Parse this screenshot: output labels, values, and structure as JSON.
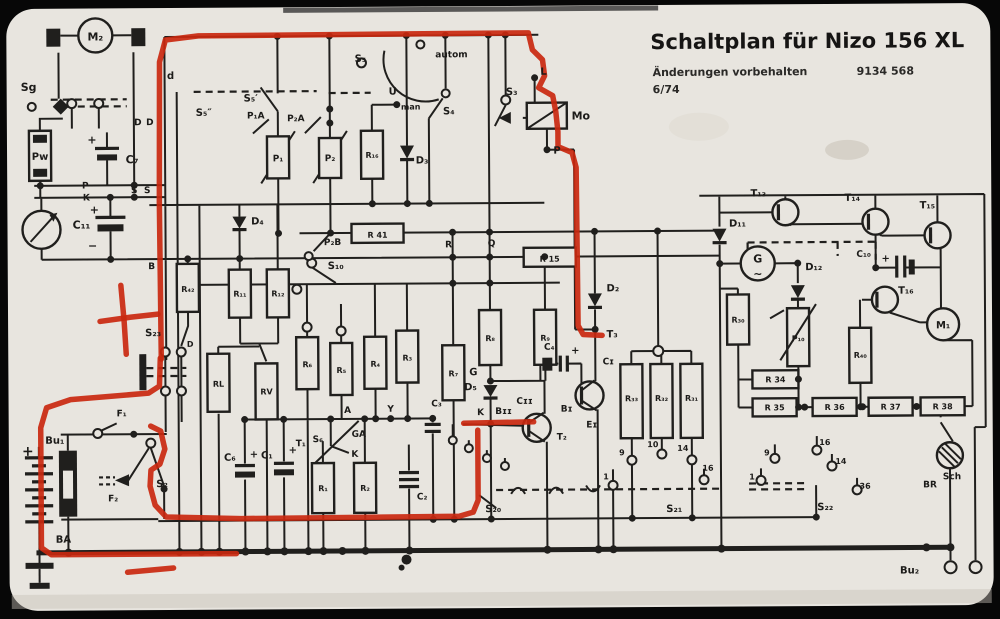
{
  "title": {
    "main": "Schaltplan für Nizo 156 XL",
    "sub": "Änderungen vorbehalten",
    "number": "9134 568",
    "date": "6/74"
  },
  "colors": {
    "paper": "#e8e5df",
    "ink": "#201f1d",
    "annotation": "#c9280f"
  },
  "annotation": {
    "paths": [
      "161,357 160,200 161,60 167,38 200,34 530,33 534,50 544,60 546,76 540,88 554,96 557,112 559,132 559,147 573,153 577,168 578,326 583,335 602,336",
      "160,356 159,384 148,391 70,397 46,405 40,425 40,545 50,552 235,552",
      "150,424 160,429 164,447 159,462 150,468 149,484 154,503 165,515 240,517 458,516 472,512 477,500 477,430",
      "463,423 533,422",
      "100,319 130,315 158,312",
      "121,283 124,318 126,352",
      "126,570 172,566"
    ]
  },
  "labels": [
    {
      "t": "M₂",
      "x": 97,
      "y": 38,
      "s": 11
    },
    {
      "t": "Sg",
      "x": 30,
      "y": 88,
      "s": 11
    },
    {
      "t": "D",
      "x": 139,
      "y": 123,
      "s": 9
    },
    {
      "t": "D",
      "x": 151,
      "y": 123,
      "s": 9
    },
    {
      "t": "Pw",
      "x": 41,
      "y": 157,
      "s": 10
    },
    {
      "t": "C₇",
      "x": 133,
      "y": 161,
      "s": 11
    },
    {
      "t": "+",
      "x": 93,
      "y": 141,
      "s": 11
    },
    {
      "t": "P",
      "x": 86,
      "y": 186,
      "s": 9
    },
    {
      "t": "K",
      "x": 87,
      "y": 198,
      "s": 9
    },
    {
      "t": "S",
      "x": 135,
      "y": 191,
      "s": 9
    },
    {
      "t": "S",
      "x": 148,
      "y": 191,
      "s": 9
    },
    {
      "t": "C₁₁",
      "x": 82,
      "y": 226,
      "s": 11
    },
    {
      "t": "+",
      "x": 95,
      "y": 211,
      "s": 11
    },
    {
      "t": "−",
      "x": 93,
      "y": 247,
      "s": 11
    },
    {
      "t": "B",
      "x": 152,
      "y": 267,
      "s": 9
    },
    {
      "t": "d",
      "x": 172,
      "y": 77,
      "s": 10
    },
    {
      "t": "S₅″",
      "x": 205,
      "y": 114,
      "s": 10
    },
    {
      "t": "S₅′",
      "x": 252,
      "y": 100,
      "s": 10
    },
    {
      "t": "P₁A",
      "x": 257,
      "y": 117,
      "s": 9
    },
    {
      "t": "P₂A",
      "x": 297,
      "y": 120,
      "s": 9
    },
    {
      "t": "P₁",
      "x": 279,
      "y": 160,
      "s": 9
    },
    {
      "t": "P₂",
      "x": 331,
      "y": 160,
      "s": 9
    },
    {
      "t": "R₁₆",
      "x": 373,
      "y": 157,
      "s": 8
    },
    {
      "t": "D₃",
      "x": 423,
      "y": 163,
      "s": 10
    },
    {
      "t": "S₅",
      "x": 362,
      "y": 61,
      "s": 10
    },
    {
      "t": "autom",
      "x": 453,
      "y": 57,
      "s": 9
    },
    {
      "t": "U",
      "x": 394,
      "y": 94,
      "s": 10
    },
    {
      "t": "man",
      "x": 412,
      "y": 109,
      "s": 8
    },
    {
      "t": "S₄",
      "x": 450,
      "y": 114,
      "s": 10
    },
    {
      "t": "S₃",
      "x": 513,
      "y": 95,
      "s": 10
    },
    {
      "t": "L",
      "x": 545,
      "y": 75,
      "s": 10
    },
    {
      "t": "Mo",
      "x": 582,
      "y": 120,
      "s": 11
    },
    {
      "t": "P",
      "x": 558,
      "y": 154,
      "s": 10
    },
    {
      "t": "P₂B",
      "x": 333,
      "y": 244,
      "s": 9
    },
    {
      "t": "R 41",
      "x": 378,
      "y": 237,
      "s": 8
    },
    {
      "t": "R",
      "x": 449,
      "y": 247,
      "s": 9
    },
    {
      "t": "Q",
      "x": 492,
      "y": 246,
      "s": 9
    },
    {
      "t": "R 15",
      "x": 550,
      "y": 262,
      "s": 8
    },
    {
      "t": "S₁₀",
      "x": 336,
      "y": 268,
      "s": 10
    },
    {
      "t": "D₄",
      "x": 258,
      "y": 223,
      "s": 10
    },
    {
      "t": "R₄₂",
      "x": 188,
      "y": 290,
      "s": 8
    },
    {
      "t": "R₁₁",
      "x": 240,
      "y": 295,
      "s": 8
    },
    {
      "t": "R₁₂",
      "x": 278,
      "y": 295,
      "s": 8
    },
    {
      "t": "S₂₃",
      "x": 153,
      "y": 334,
      "s": 10
    },
    {
      "t": "D",
      "x": 190,
      "y": 345,
      "s": 8
    },
    {
      "t": "RL",
      "x": 218,
      "y": 385,
      "s": 8
    },
    {
      "t": "RV",
      "x": 266,
      "y": 393,
      "s": 8
    },
    {
      "t": "R₆",
      "x": 307,
      "y": 366,
      "s": 8
    },
    {
      "t": "R₅",
      "x": 341,
      "y": 372,
      "s": 8
    },
    {
      "t": "R₄",
      "x": 375,
      "y": 366,
      "s": 8
    },
    {
      "t": "R₃",
      "x": 407,
      "y": 360,
      "s": 8
    },
    {
      "t": "R₇",
      "x": 453,
      "y": 376,
      "s": 8
    },
    {
      "t": "R₈",
      "x": 490,
      "y": 341,
      "s": 8
    },
    {
      "t": "R₉",
      "x": 545,
      "y": 341,
      "s": 8
    },
    {
      "t": "D₂",
      "x": 613,
      "y": 292,
      "s": 10
    },
    {
      "t": "T₃",
      "x": 612,
      "y": 338,
      "s": 10
    },
    {
      "t": "G",
      "x": 473,
      "y": 375,
      "s": 10
    },
    {
      "t": "D₅",
      "x": 470,
      "y": 390,
      "s": 10
    },
    {
      "t": "K",
      "x": 480,
      "y": 415,
      "s": 9
    },
    {
      "t": "Bɪɪ",
      "x": 503,
      "y": 414,
      "s": 9
    },
    {
      "t": "Cɪɪ",
      "x": 524,
      "y": 404,
      "s": 9
    },
    {
      "t": "T₂",
      "x": 561,
      "y": 440,
      "s": 9
    },
    {
      "t": "C₄",
      "x": 549,
      "y": 350,
      "s": 9
    },
    {
      "t": "+",
      "x": 575,
      "y": 354,
      "s": 10
    },
    {
      "t": "Cɪ",
      "x": 608,
      "y": 365,
      "s": 9
    },
    {
      "t": "Bɪ",
      "x": 566,
      "y": 412,
      "s": 9
    },
    {
      "t": "Eɪ",
      "x": 591,
      "y": 428,
      "s": 9
    },
    {
      "t": "R₃₃",
      "x": 631,
      "y": 402,
      "s": 8
    },
    {
      "t": "R₃₂",
      "x": 661,
      "y": 402,
      "s": 8
    },
    {
      "t": "R₃₁",
      "x": 691,
      "y": 402,
      "s": 8
    },
    {
      "t": "9",
      "x": 621,
      "y": 456,
      "s": 8
    },
    {
      "t": "10",
      "x": 652,
      "y": 448,
      "s": 8
    },
    {
      "t": "14",
      "x": 682,
      "y": 452,
      "s": 8
    },
    {
      "t": "1",
      "x": 605,
      "y": 480,
      "s": 8
    },
    {
      "t": "16",
      "x": 707,
      "y": 472,
      "s": 8
    },
    {
      "t": "S₂₁",
      "x": 673,
      "y": 513,
      "s": 10
    },
    {
      "t": "S₂₀",
      "x": 492,
      "y": 512,
      "s": 10
    },
    {
      "t": "C₆",
      "x": 229,
      "y": 459,
      "s": 10
    },
    {
      "t": "+",
      "x": 253,
      "y": 456,
      "s": 10
    },
    {
      "t": "C₁",
      "x": 266,
      "y": 457,
      "s": 10
    },
    {
      "t": "+",
      "x": 292,
      "y": 452,
      "s": 10
    },
    {
      "t": "T₁",
      "x": 300,
      "y": 445,
      "s": 9
    },
    {
      "t": "S₆",
      "x": 317,
      "y": 441,
      "s": 9
    },
    {
      "t": "A",
      "x": 347,
      "y": 412,
      "s": 9
    },
    {
      "t": "GA",
      "x": 358,
      "y": 436,
      "s": 9
    },
    {
      "t": "K",
      "x": 354,
      "y": 456,
      "s": 9
    },
    {
      "t": "Y",
      "x": 390,
      "y": 411,
      "s": 9
    },
    {
      "t": "R₁",
      "x": 322,
      "y": 490,
      "s": 8
    },
    {
      "t": "R₂",
      "x": 364,
      "y": 490,
      "s": 8
    },
    {
      "t": "C₃",
      "x": 436,
      "y": 406,
      "s": 9
    },
    {
      "t": "C₂",
      "x": 421,
      "y": 499,
      "s": 9
    },
    {
      "t": "+",
      "x": 27,
      "y": 453,
      "s": 14
    },
    {
      "t": "Bu₁",
      "x": 54,
      "y": 441,
      "s": 10
    },
    {
      "t": "F₁",
      "x": 121,
      "y": 414,
      "s": 9
    },
    {
      "t": "F₂",
      "x": 112,
      "y": 499,
      "s": 9
    },
    {
      "t": "S₂",
      "x": 161,
      "y": 485,
      "s": 10
    },
    {
      "t": "BA",
      "x": 62,
      "y": 540,
      "s": 10
    },
    {
      "t": "T₁₃",
      "x": 759,
      "y": 198,
      "s": 10
    },
    {
      "t": "T₁₄",
      "x": 853,
      "y": 203,
      "s": 10
    },
    {
      "t": "T₁₅",
      "x": 928,
      "y": 211,
      "s": 10
    },
    {
      "t": "T₁₆",
      "x": 906,
      "y": 296,
      "s": 10
    },
    {
      "t": "D₁₁",
      "x": 738,
      "y": 228,
      "s": 10
    },
    {
      "t": "D₁₂",
      "x": 814,
      "y": 272,
      "s": 10
    },
    {
      "t": "G",
      "x": 758,
      "y": 264,
      "s": 11
    },
    {
      "t": "~",
      "x": 758,
      "y": 279,
      "s": 11
    },
    {
      "t": "C₁₀",
      "x": 864,
      "y": 259,
      "s": 9
    },
    {
      "t": "+",
      "x": 886,
      "y": 264,
      "s": 10
    },
    {
      "t": "R₃₀",
      "x": 738,
      "y": 324,
      "s": 8
    },
    {
      "t": "P₁₀",
      "x": 798,
      "y": 343,
      "s": 8
    },
    {
      "t": "R₄₀",
      "x": 860,
      "y": 360,
      "s": 8
    },
    {
      "t": "M₁",
      "x": 943,
      "y": 331,
      "s": 10
    },
    {
      "t": "R 34",
      "x": 775,
      "y": 384,
      "s": 8
    },
    {
      "t": "R 35",
      "x": 774,
      "y": 412,
      "s": 8
    },
    {
      "t": "R 36",
      "x": 834,
      "y": 412,
      "s": 8
    },
    {
      "t": "R 37",
      "x": 890,
      "y": 412,
      "s": 8
    },
    {
      "t": "R 38",
      "x": 942,
      "y": 412,
      "s": 8
    },
    {
      "t": "9",
      "x": 766,
      "y": 457,
      "s": 8
    },
    {
      "t": "16",
      "x": 824,
      "y": 447,
      "s": 8
    },
    {
      "t": "14",
      "x": 840,
      "y": 466,
      "s": 8
    },
    {
      "t": "36",
      "x": 864,
      "y": 491,
      "s": 8
    },
    {
      "t": "1",
      "x": 751,
      "y": 481,
      "s": 8
    },
    {
      "t": "S₂₂",
      "x": 824,
      "y": 512,
      "s": 10
    },
    {
      "t": "BR",
      "x": 929,
      "y": 490,
      "s": 9
    },
    {
      "t": "Sch",
      "x": 951,
      "y": 482,
      "s": 9
    },
    {
      "t": "Bu₂",
      "x": 908,
      "y": 576,
      "s": 10
    }
  ]
}
